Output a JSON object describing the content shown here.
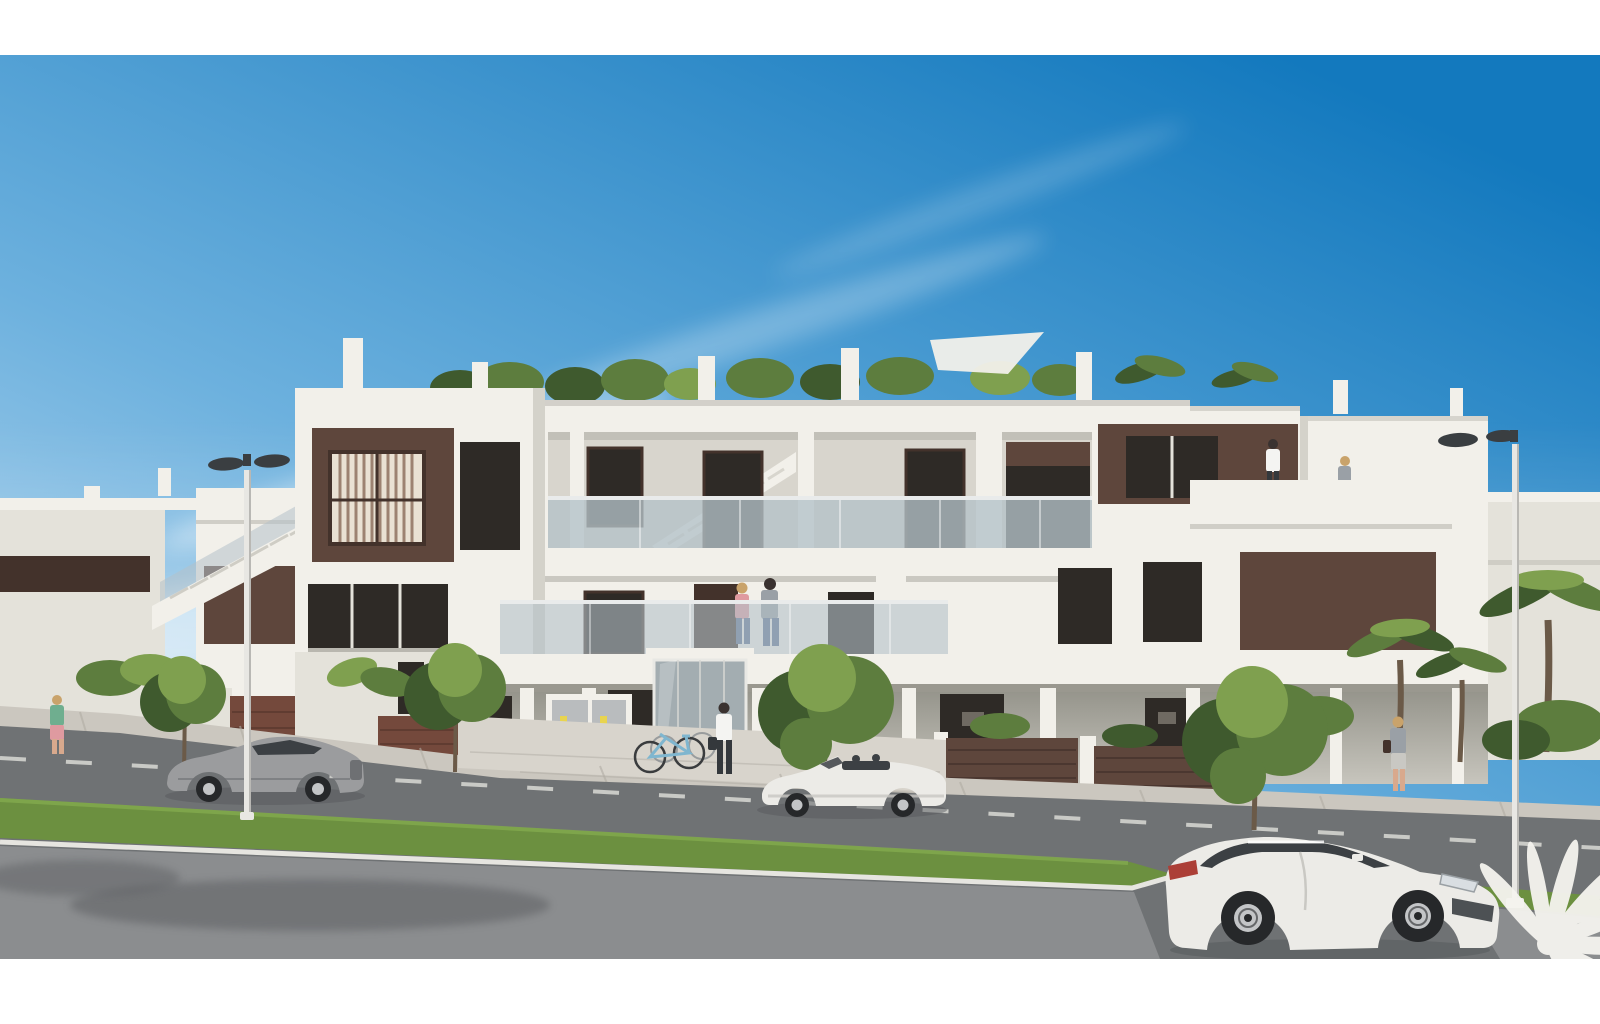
{
  "scene": {
    "type": "architectural-render",
    "title": "Street-view CGI render of a modern white three-storey apartment building with brown accent panels, glass balconies, rooftop garden, parked cars and pedestrians under a blue sky",
    "time_of_day": "day",
    "frame": "white letterbox bars at top and bottom"
  },
  "palette": {
    "sky_top": "#1379be",
    "sky_mid": "#6db1de",
    "sky_low": "#d3e7f6",
    "cloud": "#ffffff",
    "white_sun": "#f2f0ea",
    "white_shade": "#e4e2da",
    "white_dim": "#d4d2ca",
    "slab_shadow": "#b9b7af",
    "corridor_wall": "#d8d5cd",
    "porch_wall": "#c2c0b8",
    "brown_panel": "#5e463c",
    "brown_dark": "#43322b",
    "window_dark": "#2e2a26",
    "window_glass": "#a3adb1",
    "glass_rail": "#b4c1c8",
    "rail_top": "#e9ebeb",
    "curtain_light": "#e9e1d3",
    "curtain_dark": "#8a6b59",
    "green_dark": "#3f5a2e",
    "green_mid": "#5d7d3e",
    "green_light": "#7fa04f",
    "trunk": "#6b5a48",
    "brick": "#74493c",
    "brick_dark": "#54342b",
    "pavement": "#cbc7bf",
    "pavement_line": "#b0aca4",
    "plaza": "#d8d4cc",
    "road": "#6f7274",
    "road_light": "#8b8d8f",
    "road_shadow": "#54575a",
    "grass": "#6c9040",
    "grass_light": "#83aa4e",
    "curb": "#e6e5e0",
    "dash": "#d9d9d5",
    "pole": "#e8e7e3",
    "lamp_dark": "#3a3e41",
    "car_grey": "#9b9c9e",
    "car_grey_dark": "#6e7073",
    "car_win": "#3c4044",
    "car_white": "#ecebe7",
    "car_white_shade": "#c9c8c3",
    "wheel": "#26282a",
    "rim": "#c3c5c7",
    "red_tail": "#ac3f37",
    "skin": "#d8a98d",
    "hair_dark": "#3a3230",
    "hair_blonde": "#c9a36b",
    "shirt_white": "#f4f4f2",
    "shirt_grey": "#9aa0a6",
    "shirt_pink": "#df9aa0",
    "shirt_green": "#6fae8f",
    "jeans": "#5b6f91",
    "pants_dark": "#34383c",
    "bike_blue": "#7fb6cf",
    "box_grey": "#b9bcbe",
    "label_yellow": "#e8d44f",
    "watermark": "#f5f4ef"
  },
  "objects": {
    "buildings": {
      "main": "white apartment block, 3 levels, dark-brown facade panels, glass balustrades, rooftop shrubs and palms, white chimneys, central glazed stair entrance",
      "left_neighbour": "white block with external staircase, brown window bands, brick gate wall",
      "right_neighbour": "white block behind palm trees"
    },
    "vehicles": [
      {
        "kind": "coupe",
        "color": "silver-grey",
        "position": "parked left, facing left"
      },
      {
        "kind": "convertible roadster",
        "color": "white",
        "position": "parked centre, facing left, top down"
      },
      {
        "kind": "sports coupe",
        "color": "white",
        "position": "foreground right, facing right, red taillight"
      }
    ],
    "people": [
      {
        "who": "couple",
        "where": "first-floor balcony, centre"
      },
      {
        "who": "man with bag, white shirt",
        "where": "walking to entrance"
      },
      {
        "who": "two residents",
        "where": "rooftop terrace, right"
      },
      {
        "who": "woman in green top",
        "where": "left sidewalk"
      },
      {
        "who": "woman with bag",
        "where": "right sidewalk"
      }
    ],
    "street": {
      "lamps": 2,
      "sidewalk_trees": 4,
      "palm_trees": 3,
      "bicycles": 2,
      "utility_cabinets": 2,
      "road_marking": "white dashed centre line",
      "verge": "green grass strip with white curb"
    },
    "watermark": "white palm-tree logo, bottom right corner"
  }
}
